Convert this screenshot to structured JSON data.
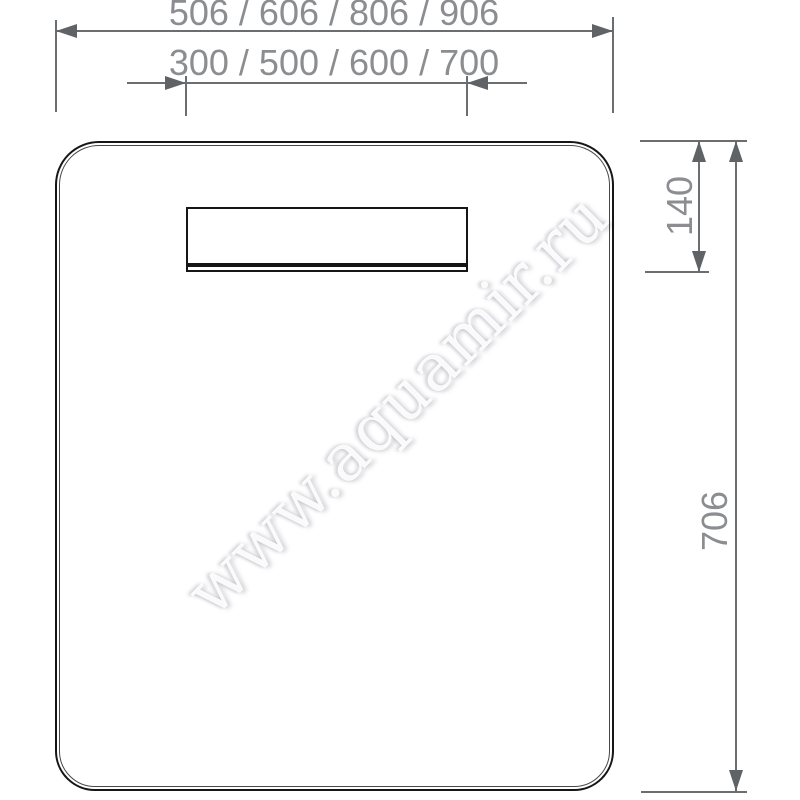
{
  "drawing": {
    "watermark": {
      "text": "www.aquamir.ru"
    },
    "dimensions": {
      "overall_width_options": "506 / 606 / 806 / 906",
      "light_width_options": "300 / 500 / 600 / 700",
      "light_offset_height": "140",
      "overall_height": "706"
    },
    "colors": {
      "background": "#ffffff",
      "outline_black": "#161616",
      "dimension_line_gray": "#6b6e70",
      "dimension_text_gray": "#8b8d90",
      "arrow_gray": "#5f6366",
      "watermark_gray": "#e9e9ec"
    }
  }
}
